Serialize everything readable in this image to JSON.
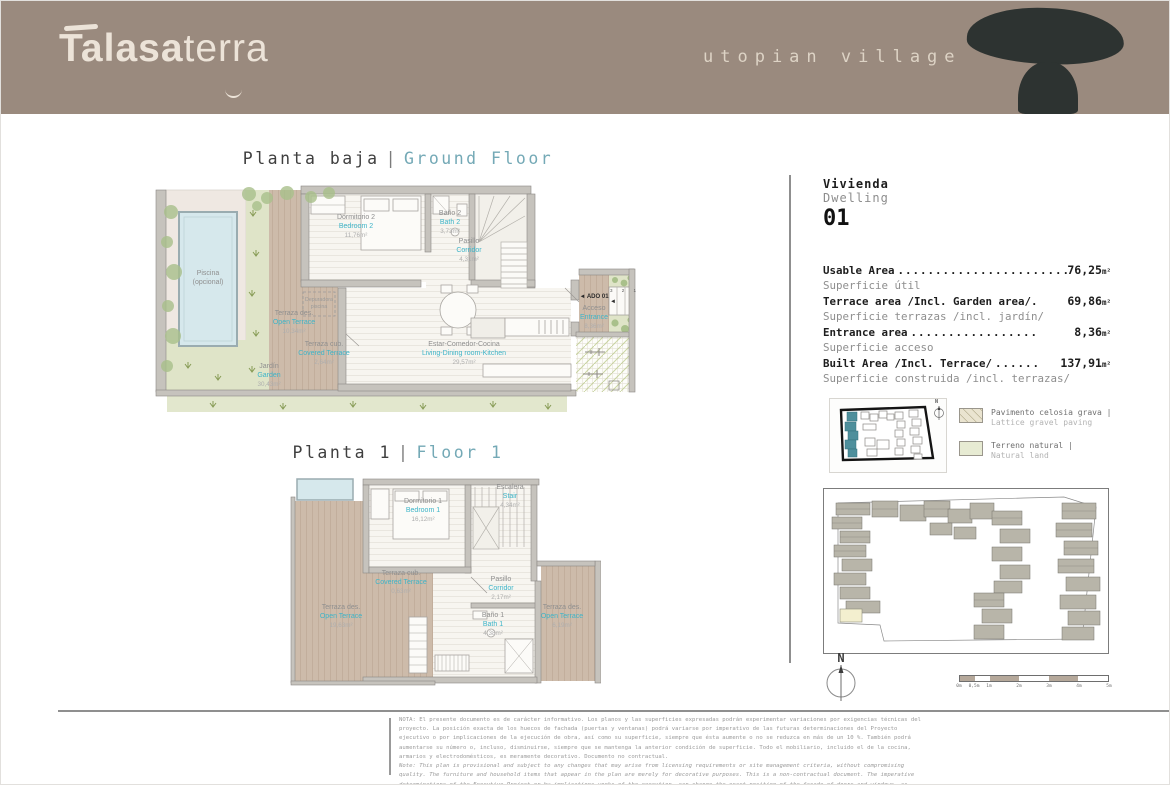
{
  "colors": {
    "header_bg": "#9a8a7e",
    "accent_teal_title": "#74a9b6",
    "accent_teal_label": "#3db4c8",
    "ink": "#3f3f3f",
    "terrace": "#cdbbaa",
    "garden": "#dfe4c8",
    "pool": "#d6e8ec",
    "stone": "#2d3331",
    "highlight_building": "#4e8f9c"
  },
  "header": {
    "brand_bold": "Talasa",
    "brand_light": "terra",
    "tagline": "utopian village"
  },
  "titles": {
    "ground_es": "Planta baja",
    "ground_sep": "|",
    "ground_en": "Ground Floor",
    "first_es": "Planta 1",
    "first_sep": "|",
    "first_en": "Floor 1"
  },
  "dwelling": {
    "es": "Vivienda",
    "en": "Dwelling",
    "number": "01"
  },
  "areas": [
    {
      "label": "Usable Area",
      "dots": "........................",
      "value": "76,25",
      "unit": "m²",
      "sub": "Superficie útil"
    },
    {
      "label": "Terrace area /Incl. Garden area/.",
      "dots": "",
      "value": "69,86",
      "unit": "m²",
      "sub": "Superficie terrazas /incl. jardín/"
    },
    {
      "label": "Entrance area",
      "dots": ".................",
      "value": "8,36",
      "unit": "m²",
      "sub": "Superficie acceso"
    },
    {
      "label": "Built Area /Incl. Terrace/",
      "dots": "......",
      "value": "137,91",
      "unit": "m²",
      "sub": "Superficie construida /incl. terrazas/"
    }
  ],
  "legend": [
    {
      "es": "Pavimento celosia grava |",
      "en": "Lattice gravel paving"
    },
    {
      "es": "Terreno natural |",
      "en": "Natural land"
    }
  ],
  "ground": {
    "piscina_es": "Piscina",
    "piscina_sub": "(opcional)",
    "jardin": {
      "es": "Jardín",
      "en": "Garden",
      "area": "30,43m²"
    },
    "open_terrace": {
      "es": "Terraza des.",
      "en": "Open Terrace",
      "area": "10,34m²"
    },
    "covered_terrace": {
      "es": "Terraza cub.",
      "en": "Covered Terrace",
      "area": "2,64m²"
    },
    "bedroom2": {
      "es": "Dormitorio 2",
      "en": "Bedroom 2",
      "area": "11,76m²"
    },
    "bath2": {
      "es": "Baño 2",
      "en": "Bath 2",
      "area": "3,73m²"
    },
    "corridor": {
      "es": "Pasillo",
      "en": "Corridor",
      "area": "4,31m²"
    },
    "living": {
      "es": "Estar-Comedor-Cocina",
      "en": "Living-Dining room-Kitchen",
      "area": "29,57m²"
    },
    "entrance": {
      "es": "Acceso",
      "en": "Entrance",
      "area": "8,36m²"
    },
    "ado": "◄ ADO 01",
    "ado_marker": "◄",
    "depuradora_line1": "Depuradora",
    "depuradora_line2": "piscina",
    "steps": "3 2 1"
  },
  "first": {
    "bedroom1": {
      "es": "Dormitorio 1",
      "en": "Bedroom 1",
      "area": "16,12m²"
    },
    "stair": {
      "es": "Escalera",
      "en": "Stair",
      "area": "4,34m²"
    },
    "covered_terrace": {
      "es": "Terraza cub.",
      "en": "Covered Terrace",
      "area": "0,63m²"
    },
    "corridor": {
      "es": "Pasillo",
      "en": "Corridor",
      "area": "2,17m²"
    },
    "bath1": {
      "es": "Baño 1",
      "en": "Bath 1",
      "area": "4,38m²"
    },
    "open_terrace_left": {
      "es": "Terraza des.",
      "en": "Open Terrace",
      "area": "19,63m²"
    },
    "open_terrace_right": {
      "es": "Terraza des.",
      "en": "Open Terrace",
      "area": "6,19m²"
    }
  },
  "compass": {
    "label": "N"
  },
  "scalebar": {
    "ticks": [
      "0m",
      "0,5m",
      "1m",
      "2m",
      "3m",
      "4m",
      "5m"
    ]
  },
  "footer": {
    "es": "NOTA: El presente documento es de carácter informativo. Los planos y las superficies expresadas podrán experimentar variaciones por exigencias técnicas del proyecto. La posición exacta de los huecos de fachada (puertas y ventanas) podrá variarse por imperativo de las futuras determinaciones del Proyecto ejecutivo o por implicaciones de la ejecución de obra, así como su superficie, siempre que ésta aumente o no se reduzca en más de un 10 %. También podrá aumentarse su número o, incluso, disminuirse, siempre que se mantenga la anterior condición de superficie. Todo el mobiliario, incluido el de la cocina, armarios y electrodomésticos, es meramente decorativo. Documento no contractual.",
    "en": "Note: This plan is provisional and subject to any changes that may arise from licensing requirements or site management criteria, without compromising quality. The furniture and household items that appear in the plan are merely for decorative purposes. This is a non-contractual document. The imperative determinations of the Executive Project or by implications works of the execution, can change the exact position of the facade of doors and windows, as well the surface area may also be increased or even decrease not more than a 10%."
  }
}
